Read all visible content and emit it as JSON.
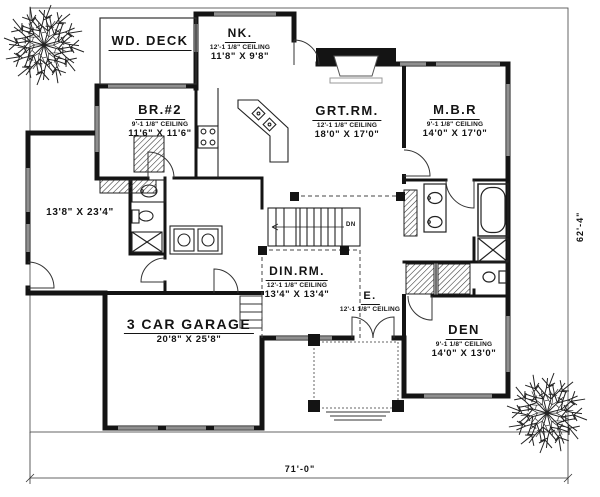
{
  "drawing": {
    "type": "floor-plan",
    "ink_color": "#141414",
    "window_color": "#8f8f8f"
  },
  "rooms": {
    "wd_deck": {
      "name": "WD. DECK"
    },
    "nk": {
      "name": "NK.",
      "ceiling": "12'-1 1/8\" CEILING",
      "size": "11'8\" X 9'8\""
    },
    "br2": {
      "name": "BR.#2",
      "ceiling": "9'-1 1/8\" CEILING",
      "size": "11'6\" X 11'6\""
    },
    "grt_rm": {
      "name": "GRT.RM.",
      "ceiling": "12'-1 1/8\" CEILING",
      "size": "18'0\" X 17'0\""
    },
    "mbr": {
      "name": "M.B.R",
      "ceiling": "9'-1 1/8\" CEILING",
      "size": "14'0\" X 17'0\""
    },
    "left_room": {
      "size": "13'8\" X 23'4\""
    },
    "din_rm": {
      "name": "DIN.RM.",
      "ceiling": "12'-1 1/8\" CEILING",
      "size": "13'4\" X 13'4\""
    },
    "entry": {
      "name": "E.",
      "ceiling": "12'-1 1/8\" CEILING"
    },
    "garage": {
      "name": "3 CAR GARAGE",
      "size": "20'8\" X 25'8\""
    },
    "den": {
      "name": "DEN",
      "ceiling": "9'-1 1/8\" CEILING",
      "size": "14'0\" X 13'0\""
    }
  },
  "stairs": {
    "label": "DN"
  },
  "dimensions": {
    "width": "71'-0\"",
    "height": "62'-4\""
  },
  "icons": {
    "tree": "deciduous-tree-plan-symbol"
  }
}
